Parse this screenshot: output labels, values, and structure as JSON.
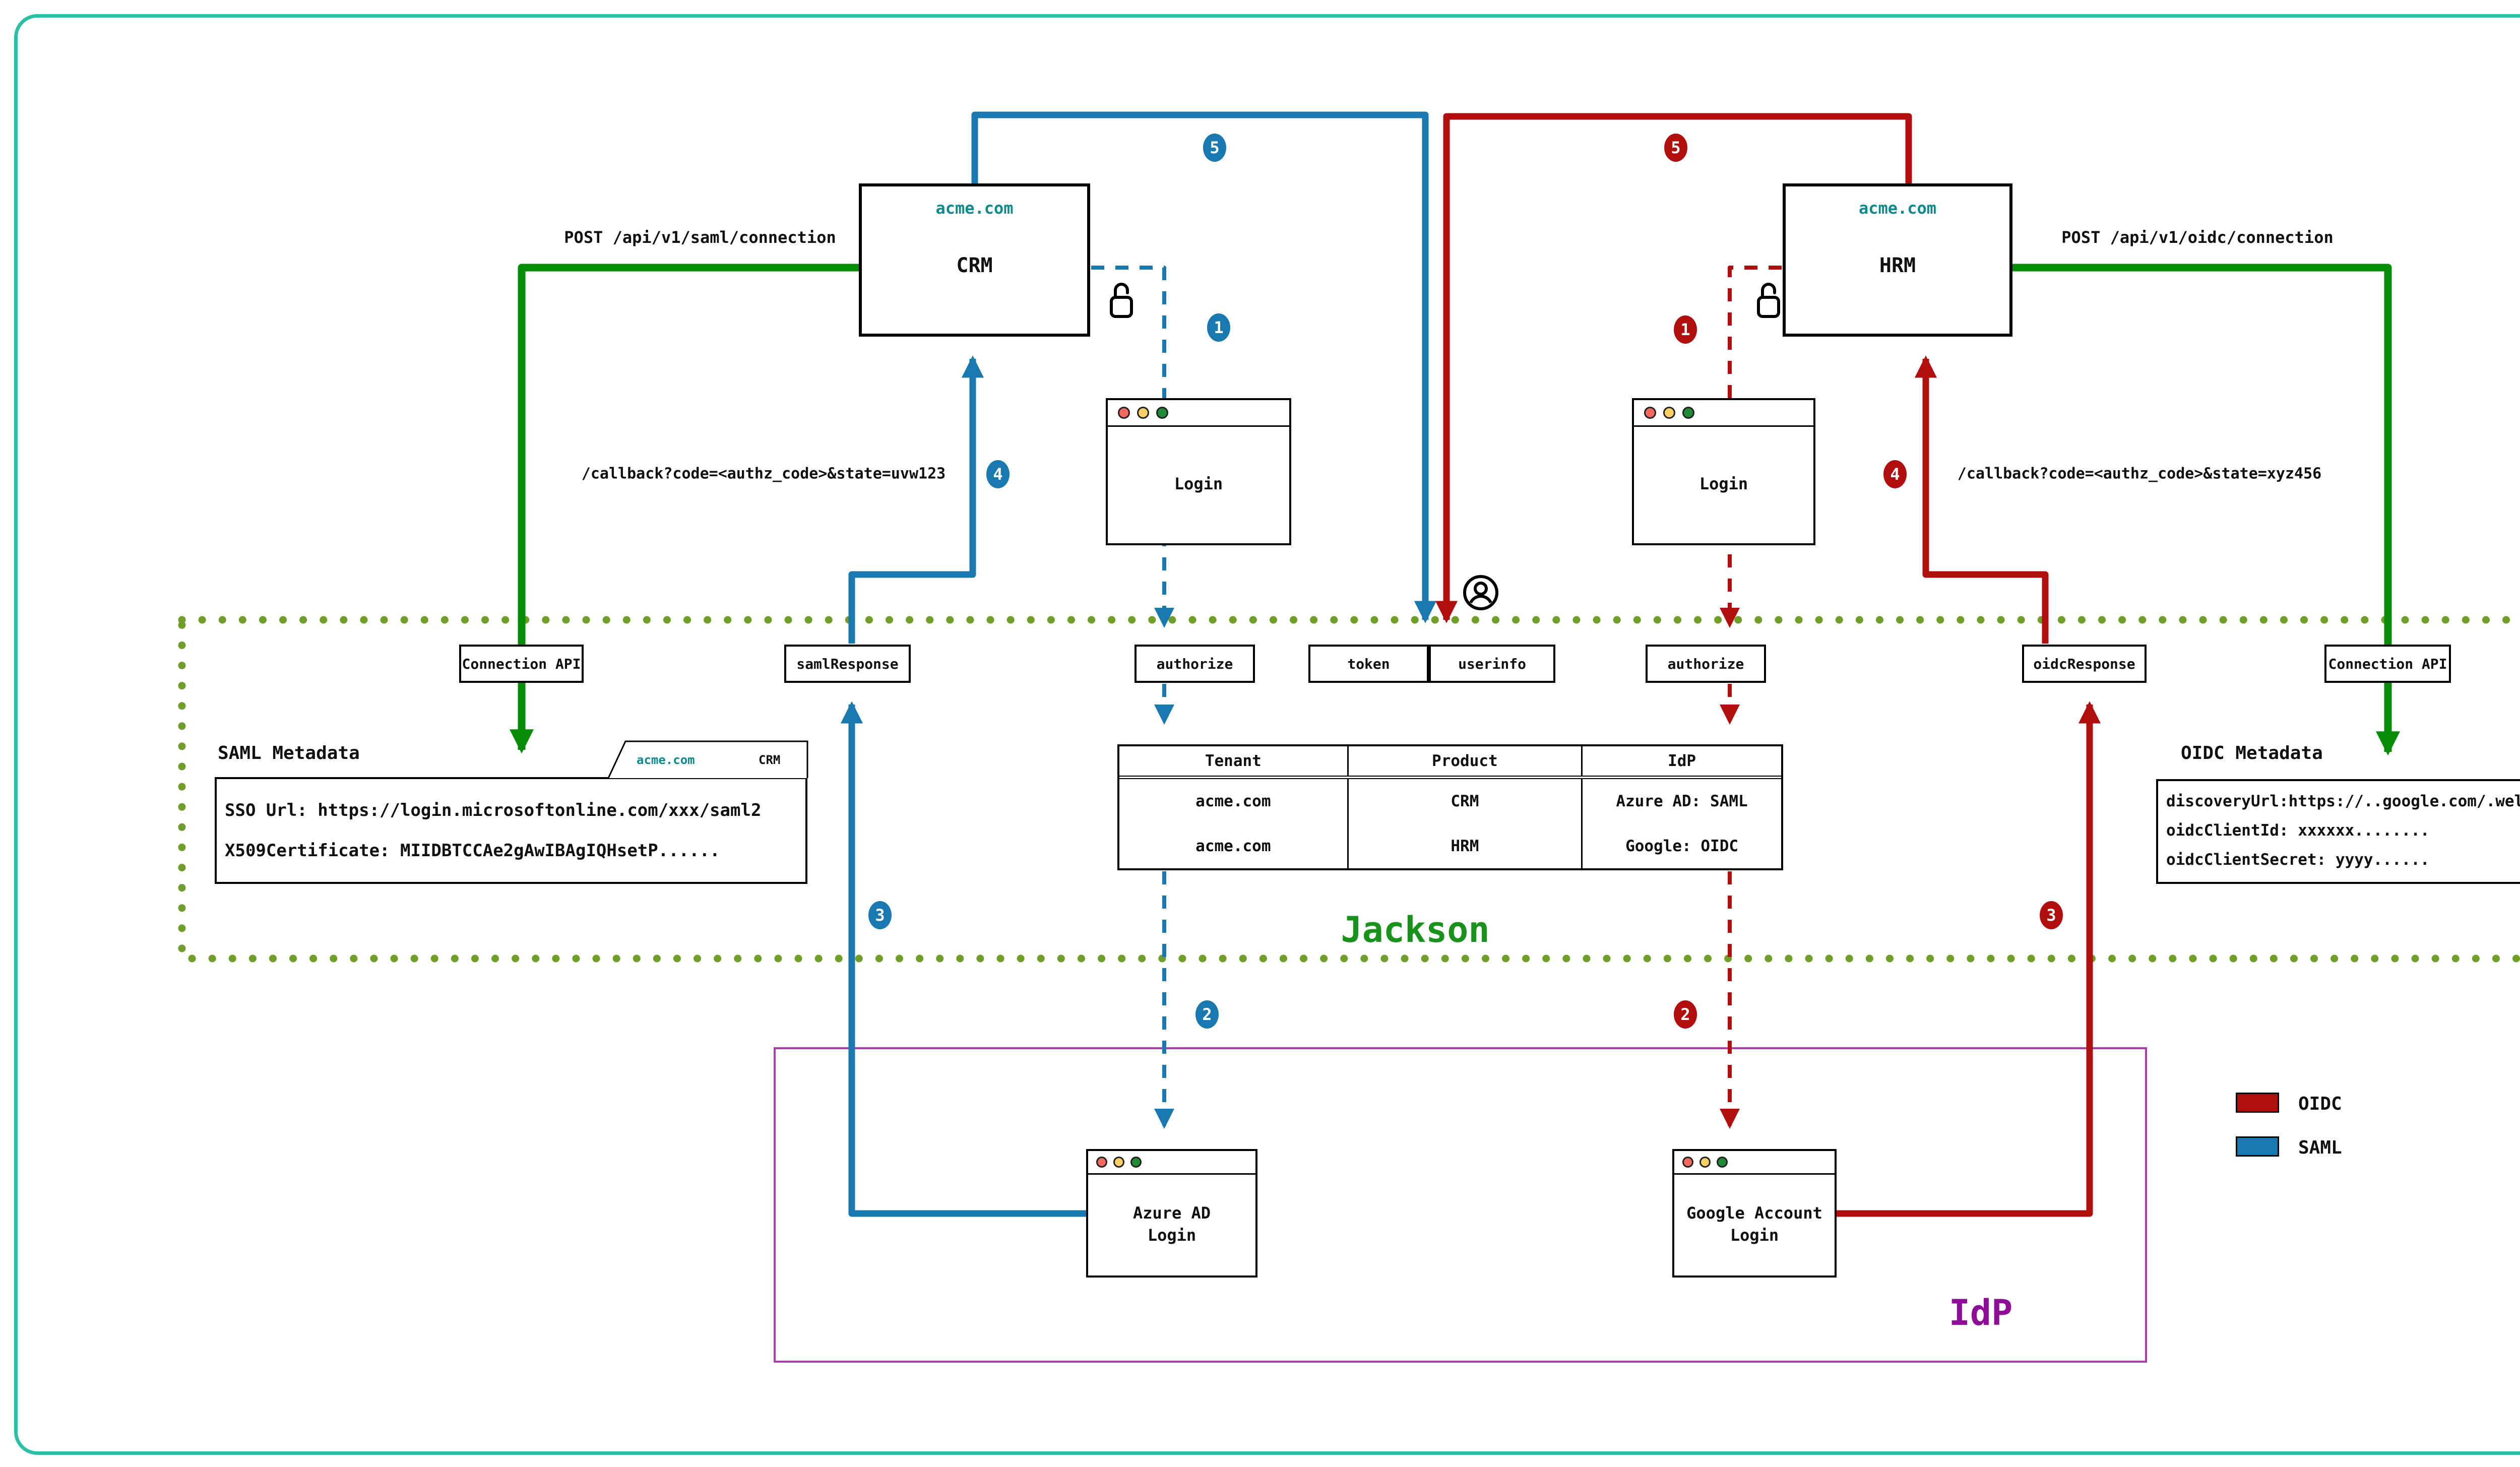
{
  "colors": {
    "frame_teal": "#2bc0a5",
    "saml_blue": "#1878b0",
    "oidc_red": "#b10e0e",
    "connection_green": "#068c06",
    "jackson_dotted_border": "#6f9f28",
    "jackson_title_green": "#18921a",
    "idp_purple": "#8e0d96",
    "domain_teal": "#0d8a8f"
  },
  "apps": {
    "crm": {
      "domain": "acme.com",
      "name": "CRM"
    },
    "hrm": {
      "domain": "acme.com",
      "name": "HRM"
    }
  },
  "labels": {
    "post_saml": "POST /api/v1/saml/connection",
    "post_oidc": "POST /api/v1/oidc/connection",
    "callback_saml": "/callback?code=<authz_code>&state=uvw123",
    "callback_oidc": "/callback?code=<authz_code>&state=xyz456"
  },
  "steps": [
    "1",
    "2",
    "3",
    "4",
    "5"
  ],
  "jackson": {
    "title": "Jackson",
    "endpoints": {
      "connection_api_left": "Connection API",
      "saml_response": "samlResponse",
      "authorize_saml": "authorize",
      "token": "token",
      "userinfo": "userinfo",
      "authorize_oidc": "authorize",
      "oidc_response": "oidcResponse",
      "connection_api_right": "Connection API"
    },
    "saml_metadata": {
      "title": "SAML Metadata",
      "tab": {
        "domain": "acme.com",
        "product": "CRM"
      },
      "lines": [
        "SSO Url: https://login.microsoftonline.com/xxx/saml2",
        "X509Certificate: MIIDBTCCAe2gAwIBAgIQHsetP......"
      ]
    },
    "oidc_metadata": {
      "title": "OIDC Metadata",
      "tab": {
        "domain": "acme.com",
        "product": "HRM"
      },
      "lines": [
        "discoveryUrl:https://..google.com/.well-known/openid-configuration",
        "oidcClientId: xxxxxx........",
        "oidcClientSecret: yyyy......"
      ]
    },
    "connections_table": {
      "headers": [
        "Tenant",
        "Product",
        "IdP"
      ],
      "rows": [
        [
          "acme.com",
          "CRM",
          "Azure AD: SAML"
        ],
        [
          "acme.com",
          "HRM",
          "Google: OIDC"
        ]
      ]
    }
  },
  "windows": {
    "login_saml": {
      "title": "Login"
    },
    "login_oidc": {
      "title": "Login"
    },
    "azure": {
      "line1": "Azure AD",
      "line2": "Login"
    },
    "google": {
      "line1": "Google Account",
      "line2": "Login"
    }
  },
  "idp": {
    "title": "IdP"
  },
  "legend": [
    {
      "label": "OIDC",
      "color": "#b10e0e"
    },
    {
      "label": "SAML",
      "color": "#1878b0"
    }
  ]
}
